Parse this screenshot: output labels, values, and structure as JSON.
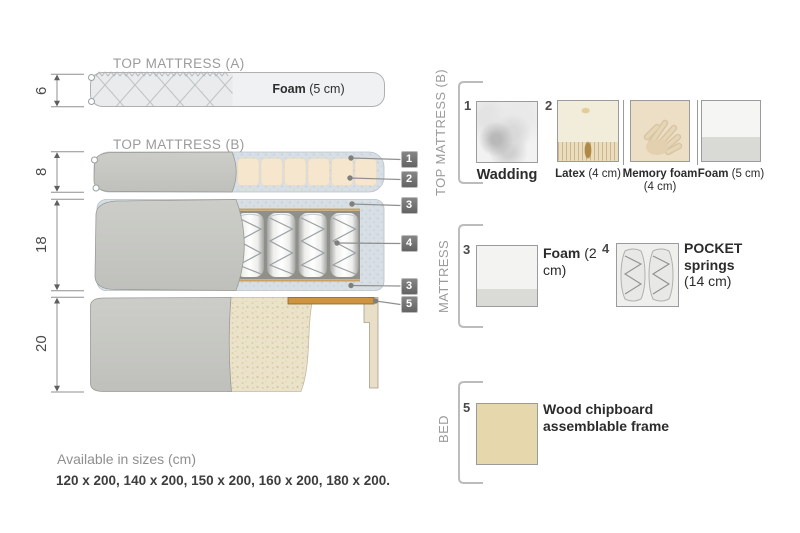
{
  "colors": {
    "cover_gray": "#c7c8c3",
    "wadding_blue": "#d6dee4",
    "cream_block": "#f6e6cd",
    "wood_slat": "#ce9440",
    "chipboard_tan": "#e7d7ac",
    "badge_gray": "#6f6f6f",
    "text_gray": "#9b9b9b",
    "text_dark": "#3d3d3d"
  },
  "diagram": {
    "sections": [
      {
        "id": "top_mattress_a",
        "title": "TOP MATTRESS (A)",
        "dimension": "6",
        "inline_label": {
          "bold": "Foam",
          "rest": " (5 cm)"
        }
      },
      {
        "id": "top_mattress_b",
        "title": "TOP MATTRESS (B)",
        "dimension": "8"
      },
      {
        "id": "mattress",
        "dimension": "18"
      },
      {
        "id": "bed",
        "dimension": "20"
      }
    ],
    "callouts": [
      {
        "num": "1"
      },
      {
        "num": "2"
      },
      {
        "num": "3"
      },
      {
        "num": "4"
      },
      {
        "num": "3"
      },
      {
        "num": "5"
      }
    ]
  },
  "legend": {
    "sections": [
      {
        "title": "TOP MATTRESS (B)",
        "items": [
          {
            "num": "1",
            "name": "Wadding",
            "detail": ""
          },
          {
            "num": "2",
            "name": "Latex",
            "detail": "(4 cm)"
          },
          {
            "num": "",
            "name": "Memory foam",
            "detail": "(4 cm)"
          },
          {
            "num": "",
            "name": "Foam",
            "detail": "(5 cm)"
          }
        ]
      },
      {
        "title": "MATTRESS",
        "items": [
          {
            "num": "3",
            "name": "Foam",
            "detail": "(2 cm)"
          },
          {
            "num": "4",
            "name": "POCKET springs",
            "detail": "(14 cm)"
          }
        ]
      },
      {
        "title": "BED",
        "items": [
          {
            "num": "5",
            "name": "Wood chipboard assemblable frame",
            "detail": ""
          }
        ]
      }
    ]
  },
  "footer": {
    "title": "Available in sizes (cm)",
    "sizes": "120 x 200, 140 x 200, 150 x 200, 160 x 200, 180 x 200."
  }
}
